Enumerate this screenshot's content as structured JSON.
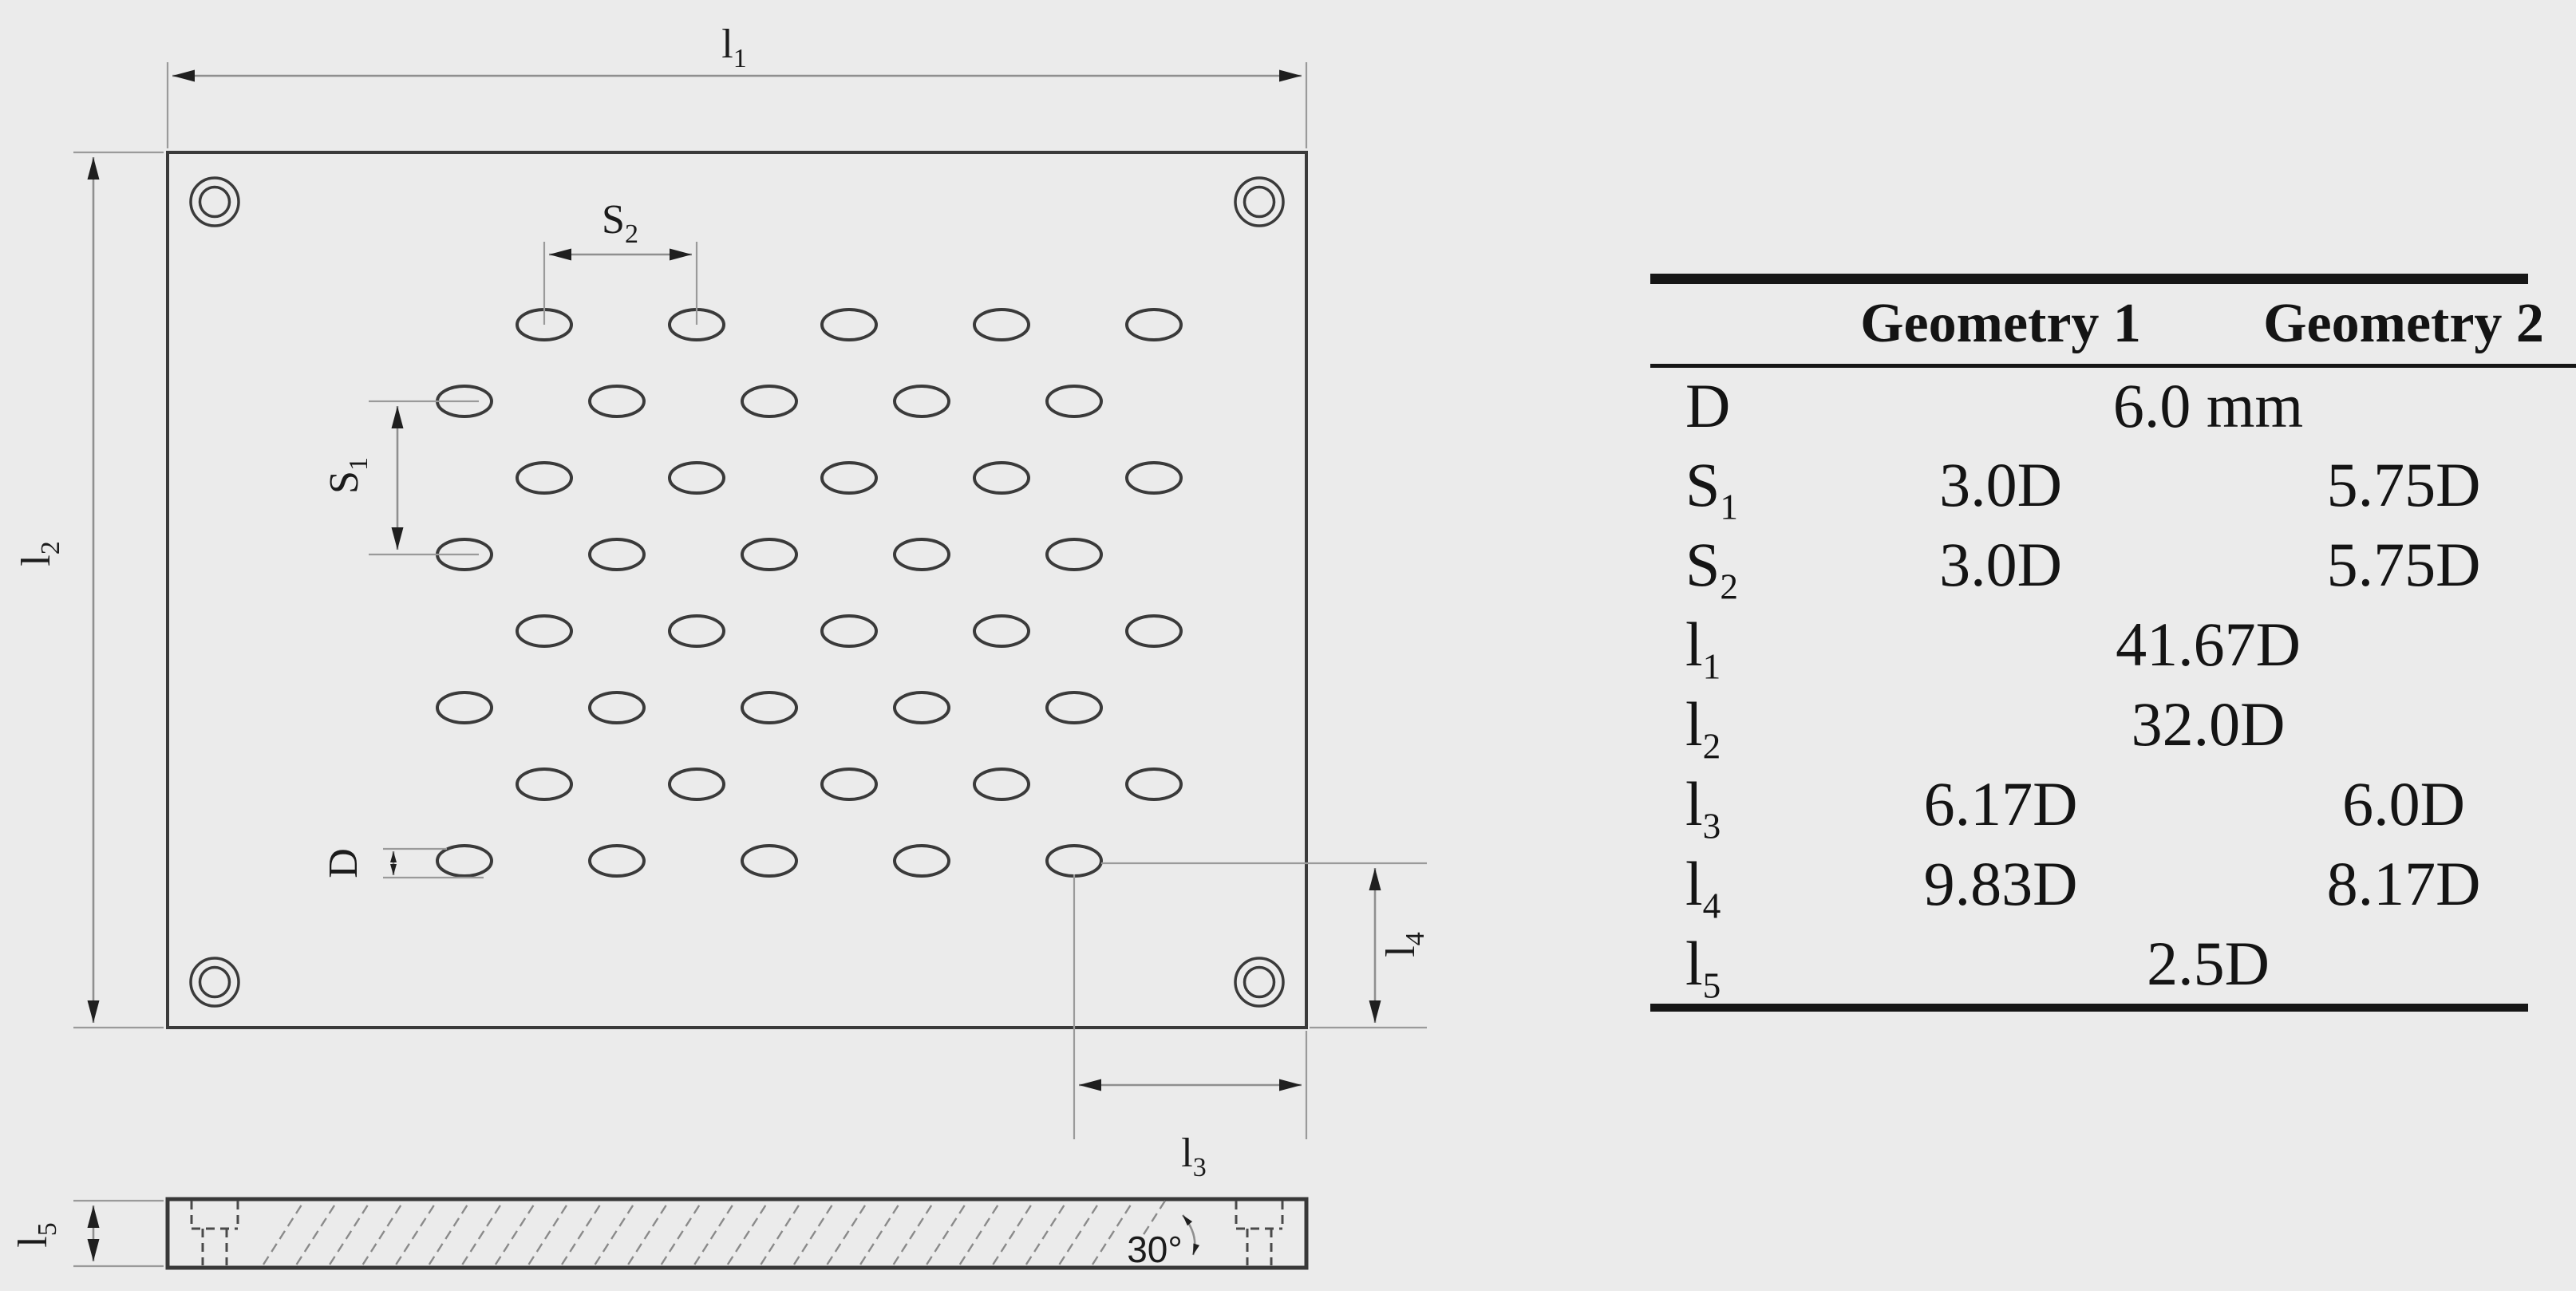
{
  "colors": {
    "background": "#ebebeb",
    "drawing_lines": "#3a3a3a",
    "dimension_lines": "#8f8f8f",
    "text": "#141414"
  },
  "drawing": {
    "labels": {
      "l1": {
        "base": "l",
        "sub": "1"
      },
      "l2": {
        "base": "l",
        "sub": "2"
      },
      "l3": {
        "base": "l",
        "sub": "3"
      },
      "l4": {
        "base": "l",
        "sub": "4"
      },
      "l5": {
        "base": "l",
        "sub": "5"
      },
      "s1": {
        "base": "S",
        "sub": "1"
      },
      "s2": {
        "base": "S",
        "sub": "2"
      },
      "d": {
        "base": "D",
        "sub": ""
      },
      "angle": "30°"
    }
  },
  "table": {
    "col_headers": [
      "Geometry 1",
      "Geometry 2"
    ],
    "rows": [
      {
        "base": "D",
        "sub": "",
        "value": "6.0 mm"
      },
      {
        "base": "S",
        "sub": "1",
        "g1": "3.0D",
        "g2": "5.75D"
      },
      {
        "base": "S",
        "sub": "2",
        "g1": "3.0D",
        "g2": "5.75D"
      },
      {
        "base": "l",
        "sub": "1",
        "value": "41.67D"
      },
      {
        "base": "l",
        "sub": "2",
        "value": "32.0D"
      },
      {
        "base": "l",
        "sub": "3",
        "g1": "6.17D",
        "g2": "6.0D"
      },
      {
        "base": "l",
        "sub": "4",
        "g1": "9.83D",
        "g2": "8.17D"
      },
      {
        "base": "l",
        "sub": "5",
        "value": "2.5D"
      }
    ]
  }
}
